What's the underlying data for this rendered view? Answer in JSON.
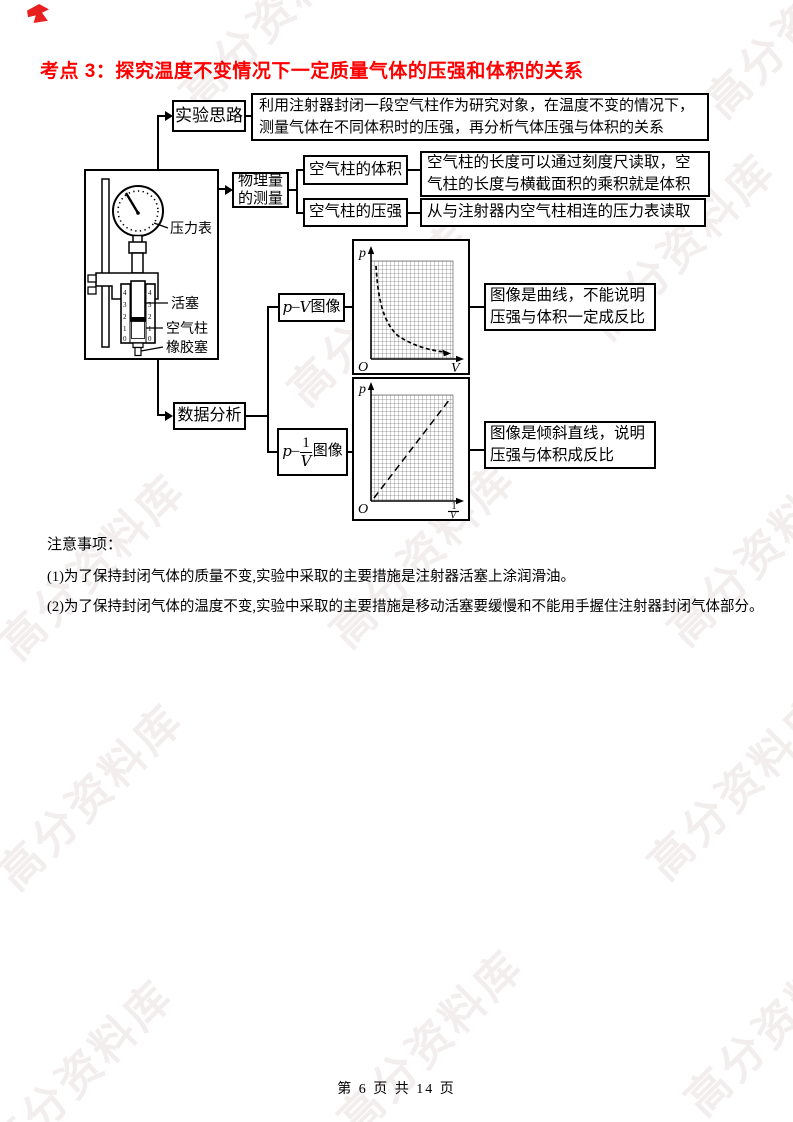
{
  "page": {
    "title": "考点 3：探究温度不变情况下一定质量气体的压强和体积的关系",
    "title_color": "#fe0000",
    "footer": "第 6 页 共 14 页",
    "watermark": "高分资料库"
  },
  "flowchart": {
    "experiment_idea_label": "实验思路",
    "experiment_idea_text": "利用注射器封闭一段空气柱作为研究对象，在温度不变的情况下，测量气体在不同体积时的压强，再分析气体压强与体积的关系",
    "measurement_label": "物理量的测量",
    "volume_label": "空气柱的体积",
    "volume_text": "空气柱的长度可以通过刻度尺读取，空气柱的长度与横截面积的乘积就是体积",
    "pressure_label": "空气柱的压强",
    "pressure_text": "从与注射器内空气柱相连的压力表读取",
    "data_analysis_label": "数据分析",
    "pv_box": {
      "p": "p",
      "dash": "–",
      "v": "V",
      "suffix": "图像"
    },
    "pinv_box": {
      "p": "p",
      "dash": "–",
      "num": "1",
      "den": "V",
      "suffix": "图像"
    },
    "conclusion_pv": "图像是曲线，不能说明压强与体积一定成反比",
    "conclusion_pinv": "图像是倾斜直线，说明压强与体积成反比"
  },
  "apparatus": {
    "labels": {
      "gauge": "压力表",
      "piston": "活塞",
      "air_column": "空气柱",
      "stopper": "橡胶塞"
    },
    "scale": [
      "4",
      "3",
      "2",
      "1",
      "0"
    ]
  },
  "graphs": {
    "pv": {
      "y_axis": "p",
      "x_axis": "V",
      "origin": "O",
      "shape": "hyperbola-curve"
    },
    "pinv": {
      "y_axis": "p",
      "x_num": "1",
      "x_den": "V",
      "origin": "O",
      "shape": "dashed-straight-line"
    }
  },
  "notes": {
    "heading": "注意事项：",
    "items": [
      "(1)为了保持封闭气体的质量不变,实验中采取的主要措施是注射器活塞上涂润滑油。",
      "(2)为了保持封闭气体的温度不变,实验中采取的主要措施是移动活塞要缓慢和不能用手握住注射器封闭气体部分。"
    ]
  }
}
